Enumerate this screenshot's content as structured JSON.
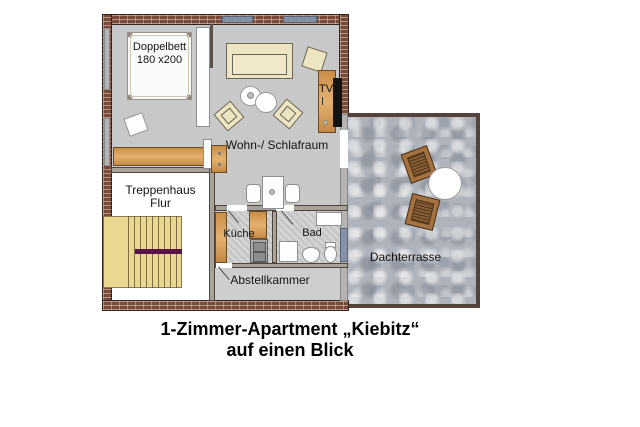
{
  "caption": {
    "line1": "1-Zimmer-Apartment „Kiebitz“",
    "line2": "auf einen Blick"
  },
  "labels": {
    "bed_line1": "Doppelbett",
    "bed_line2": "180 x200",
    "living_room": "Wohn-/ Schlafraum",
    "tv": "TV",
    "stairwell_line1": "Treppenhaus",
    "stairwell_line2": "Flur",
    "kitchen": "Küche",
    "bathroom": "Bad",
    "storage": "Abstellkammer",
    "terrace": "Dachterrasse"
  },
  "colors": {
    "floor_gray": "#c8c8c8",
    "wall_brick": "#855341",
    "window_slate": "#8691a6",
    "wood": "#dc9f56",
    "upholstery_cream": "#ede4c2",
    "stairs_yellow": "#e9d88f",
    "stairs_accent_purple": "#5a1348",
    "terrace_stone": "#afb4bc",
    "terrace_wood": "#a5713f"
  }
}
